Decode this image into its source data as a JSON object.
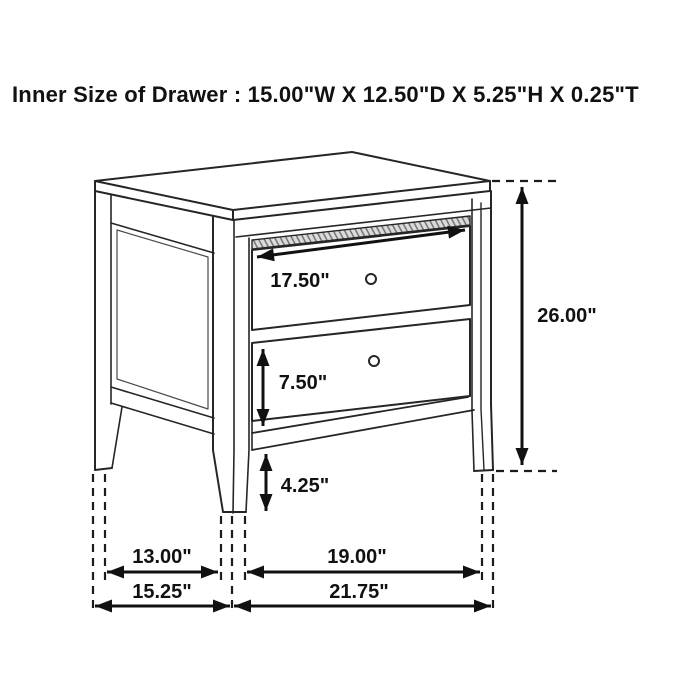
{
  "header": {
    "title": "Inner Size of Drawer : 15.00\"W X 12.50\"D X 5.25\"H X 0.25\"T"
  },
  "diagram": {
    "dimensions": {
      "drawer_width": "17.50\"",
      "overall_height": "26.00\"",
      "drawer_height": "7.50\"",
      "floor_clearance": "4.25\"",
      "side_leg_span": "13.00\"",
      "front_leg_span": "19.00\"",
      "overall_depth": "15.25\"",
      "overall_width": "21.75\""
    }
  }
}
